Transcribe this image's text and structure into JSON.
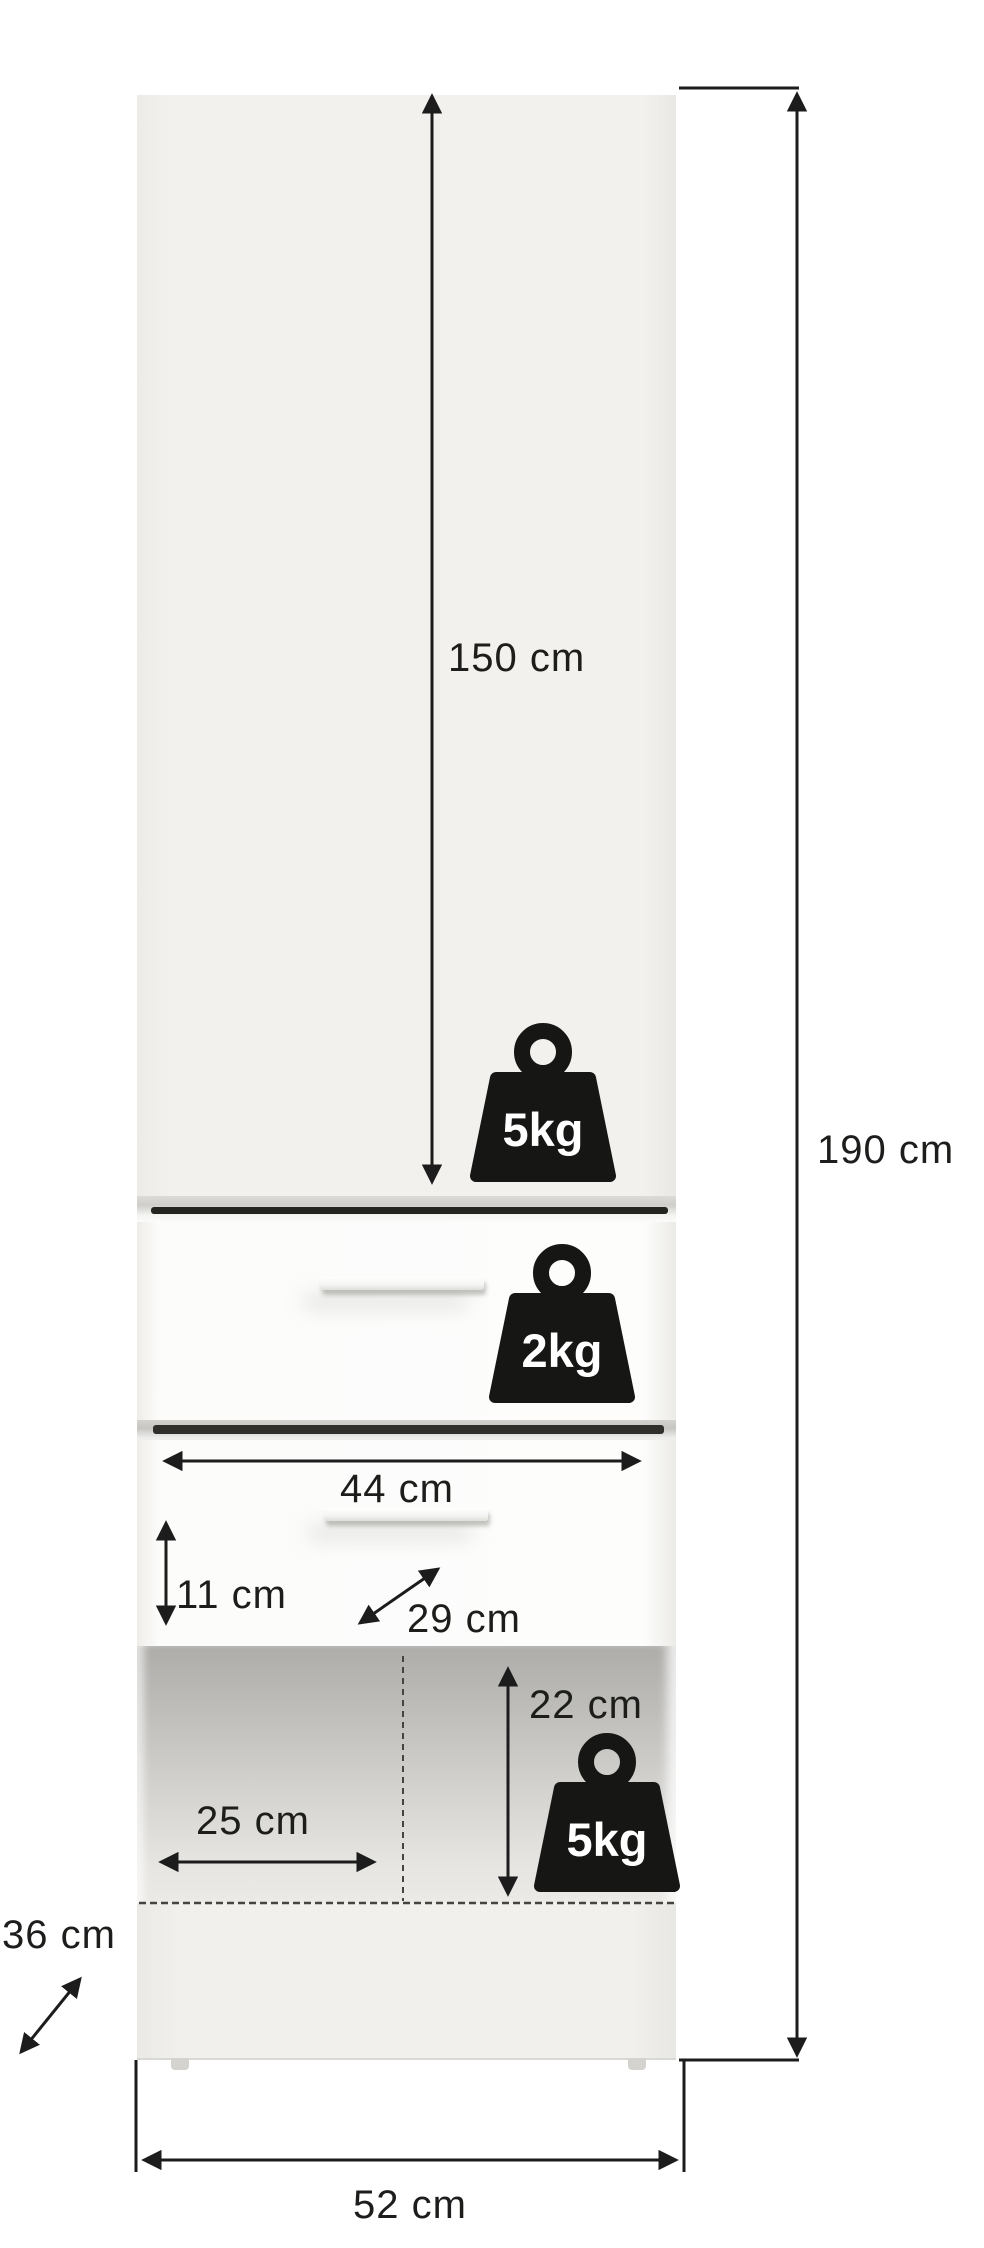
{
  "diagram": {
    "product": "tall cabinet with door, two drawers and open shelf",
    "dimensions": {
      "door_height": "150 cm",
      "total_height": "190 cm",
      "drawer_inner_width": "44 cm",
      "drawer_inner_height": "11 cm",
      "drawer_inner_depth": "29 cm",
      "shelf_niche_height": "22 cm",
      "shelf_niche_depth": "25 cm",
      "cabinet_depth": "36 cm",
      "cabinet_width": "52 cm"
    },
    "load_capacities": {
      "door_section": "5kg",
      "drawer": "2kg",
      "open_shelf": "5kg"
    },
    "colors": {
      "background": "#ffffff",
      "outline": "#1c1c1c",
      "cabinet_body": "#f1f0ec",
      "drawer_front": "#fcfcfb",
      "shelf_interior_top": "#aeadaa",
      "shelf_interior_bottom": "#eceae6",
      "icon_fill": "#161614",
      "icon_text": "#ffffff"
    }
  }
}
